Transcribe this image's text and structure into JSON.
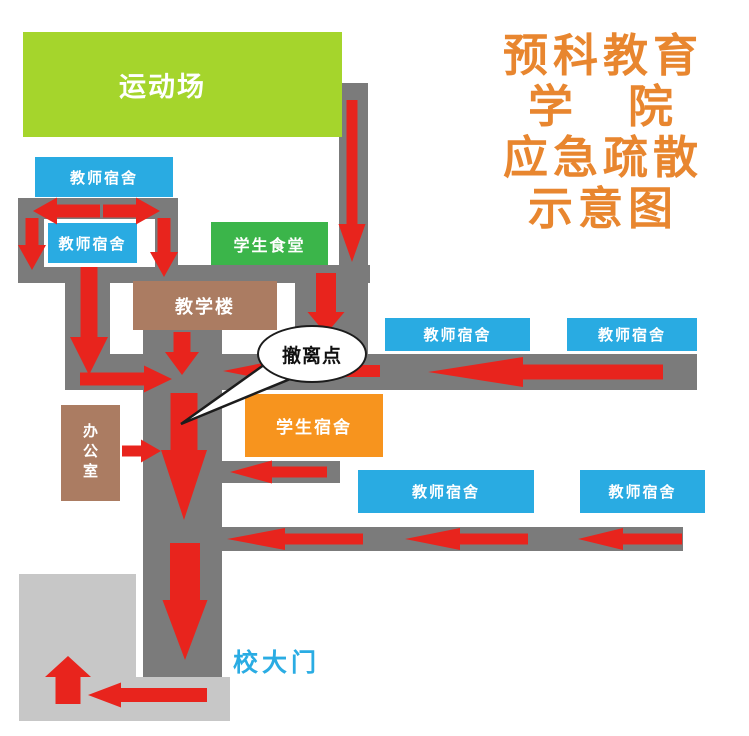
{
  "canvas": {
    "width": 749,
    "height": 736,
    "background": "#ffffff"
  },
  "colors": {
    "path_gray": "#7b7b7b",
    "open_area_gray": "#c7c7c7",
    "arrow_red": "#e8241d",
    "building_blue": "#29abe2",
    "canteen_green": "#3bb54a",
    "field_green": "#a5d52c",
    "dorm_orange": "#f7941e",
    "building_brown": "#ab7c62",
    "title_orange": "#e8862f",
    "gate_text_blue": "#2aace3",
    "bubble_outline": "#1c1c1c"
  },
  "title": {
    "lines": [
      "预科教育",
      "学　院",
      "应急疏散",
      "示意图"
    ],
    "x": 497,
    "y": 30,
    "w": 212
  },
  "gate": {
    "label": "校大门",
    "x": 233,
    "y": 643
  },
  "bubble": {
    "label": "撤离点",
    "cx": 310,
    "cy": 352,
    "rx": 53,
    "ry": 27,
    "tail_tip": [
      181,
      424
    ],
    "tail_base": [
      [
        268,
        362
      ],
      [
        295,
        377
      ]
    ]
  },
  "buildings": [
    {
      "name": "sports-field",
      "label": "运动场",
      "x": 23,
      "y": 32,
      "w": 319,
      "h": 105,
      "bg": "#a5d52c",
      "font": 27,
      "shift": -20
    },
    {
      "name": "teacher-dorm-1",
      "label": "教师宿舍",
      "x": 35,
      "y": 157,
      "w": 138,
      "h": 40,
      "bg": "#29abe2",
      "font": 15
    },
    {
      "name": "teacher-dorm-2",
      "label": "教师宿舍",
      "x": 44,
      "y": 219,
      "w": 111,
      "h": 48,
      "bg": "#29abe2",
      "font": 15,
      "border": {
        "color": "#ffffff",
        "t": 4,
        "r": 18,
        "b": 4,
        "l": 4
      }
    },
    {
      "name": "student-canteen",
      "label": "学生食堂",
      "x": 211,
      "y": 222,
      "w": 117,
      "h": 43,
      "bg": "#3bb54a",
      "font": 16
    },
    {
      "name": "teaching-building",
      "label": "教学楼",
      "x": 133,
      "y": 281,
      "w": 144,
      "h": 49,
      "bg": "#ab7c62",
      "font": 18
    },
    {
      "name": "office",
      "label": "办公室",
      "x": 61,
      "y": 405,
      "w": 59,
      "h": 96,
      "bg": "#ab7c62",
      "font": 15,
      "vertical": true
    },
    {
      "name": "student-dorm",
      "label": "学生宿舍",
      "x": 245,
      "y": 394,
      "w": 138,
      "h": 63,
      "bg": "#f7941e",
      "font": 17
    },
    {
      "name": "teacher-dorm-3",
      "label": "教师宿舍",
      "x": 385,
      "y": 318,
      "w": 145,
      "h": 33,
      "bg": "#29abe2",
      "font": 15
    },
    {
      "name": "teacher-dorm-4",
      "label": "教师宿舍",
      "x": 567,
      "y": 318,
      "w": 130,
      "h": 33,
      "bg": "#29abe2",
      "font": 15
    },
    {
      "name": "teacher-dorm-5",
      "label": "教师宿舍",
      "x": 358,
      "y": 470,
      "w": 176,
      "h": 43,
      "bg": "#29abe2",
      "font": 15
    },
    {
      "name": "teacher-dorm-6",
      "label": "教师宿舍",
      "x": 580,
      "y": 470,
      "w": 125,
      "h": 43,
      "bg": "#29abe2",
      "font": 15
    }
  ],
  "paths": [
    {
      "name": "path-top-left-block",
      "x": 18,
      "y": 198,
      "w": 160,
      "h": 85
    },
    {
      "name": "path-corridor-upper",
      "x": 18,
      "y": 265,
      "w": 352,
      "h": 18
    },
    {
      "name": "path-right-upper",
      "x": 339,
      "y": 83,
      "w": 29,
      "h": 182
    },
    {
      "name": "path-right-lower",
      "x": 295,
      "y": 265,
      "w": 73,
      "h": 92
    },
    {
      "name": "path-left-vertical",
      "x": 65,
      "y": 283,
      "w": 45,
      "h": 107
    },
    {
      "name": "path-main-corridor",
      "x": 65,
      "y": 354,
      "w": 632,
      "h": 36
    },
    {
      "name": "path-main-vertical",
      "x": 143,
      "y": 330,
      "w": 79,
      "h": 347
    },
    {
      "name": "path-stub-right",
      "x": 222,
      "y": 461,
      "w": 118,
      "h": 22
    },
    {
      "name": "path-corridor-lower",
      "x": 222,
      "y": 527,
      "w": 461,
      "h": 24
    }
  ],
  "open_areas": [
    {
      "name": "open-area-square",
      "x": 19,
      "y": 574,
      "w": 117,
      "h": 147
    },
    {
      "name": "open-area-corridor",
      "x": 136,
      "y": 677,
      "w": 94,
      "h": 44
    }
  ],
  "arrows": [
    {
      "name": "arrow-left-top",
      "dir": "left",
      "tip": [
        33,
        211
      ],
      "len": 67,
      "t": 13,
      "hl": 24,
      "hw": 27
    },
    {
      "name": "arrow-right-top",
      "dir": "right",
      "tip": [
        160,
        211
      ],
      "len": 57,
      "t": 13,
      "hl": 24,
      "hw": 27
    },
    {
      "name": "arrow-down-left-stub",
      "dir": "down",
      "tip": [
        32,
        270
      ],
      "len": 52,
      "t": 13,
      "hl": 25,
      "hw": 28
    },
    {
      "name": "arrow-down-mid-stub",
      "dir": "down",
      "tip": [
        164,
        277
      ],
      "len": 59,
      "t": 13,
      "hl": 25,
      "hw": 28
    },
    {
      "name": "arrow-down-right-path",
      "dir": "down",
      "tip": [
        352,
        262
      ],
      "len": 162,
      "t": 11,
      "hl": 38,
      "hw": 27
    },
    {
      "name": "arrow-down-right-lower",
      "dir": "down",
      "tip": [
        326,
        334
      ],
      "len": 61,
      "t": 20,
      "hl": 22,
      "hw": 37
    },
    {
      "name": "arrow-down-left-path",
      "dir": "down",
      "tip": [
        89,
        375
      ],
      "len": 108,
      "t": 17,
      "hl": 38,
      "hw": 38
    },
    {
      "name": "arrow-down-teaching",
      "dir": "down",
      "tip": [
        182,
        375
      ],
      "len": 43,
      "t": 17,
      "hl": 23,
      "hw": 34
    },
    {
      "name": "arrow-right-junction",
      "dir": "right",
      "tip": [
        172,
        379
      ],
      "len": 92,
      "t": 13,
      "hl": 28,
      "hw": 27
    },
    {
      "name": "arrow-left-junction",
      "dir": "left",
      "tip": [
        223,
        371
      ],
      "len": 157,
      "t": 12,
      "hl": 55,
      "hw": 22
    },
    {
      "name": "arrow-left-corridor-long",
      "dir": "left",
      "tip": [
        428,
        372
      ],
      "len": 235,
      "t": 15,
      "hl": 95,
      "hw": 30
    },
    {
      "name": "arrow-down-main-upper",
      "dir": "down",
      "tip": [
        184,
        520
      ],
      "len": 127,
      "t": 27,
      "hl": 70,
      "hw": 46
    },
    {
      "name": "arrow-down-main-lower",
      "dir": "down",
      "tip": [
        185,
        660
      ],
      "len": 117,
      "t": 30,
      "hl": 60,
      "hw": 45
    },
    {
      "name": "arrow-right-office",
      "dir": "right",
      "tip": [
        161,
        451
      ],
      "len": 39,
      "t": 11,
      "hl": 20,
      "hw": 23
    },
    {
      "name": "arrow-left-stub",
      "dir": "left",
      "tip": [
        230,
        472
      ],
      "len": 97,
      "t": 11,
      "hl": 42,
      "hw": 23
    },
    {
      "name": "arrow-left-lower-1",
      "dir": "left",
      "tip": [
        227,
        539
      ],
      "len": 136,
      "t": 11,
      "hl": 58,
      "hw": 22
    },
    {
      "name": "arrow-left-lower-2",
      "dir": "left",
      "tip": [
        405,
        539
      ],
      "len": 123,
      "t": 11,
      "hl": 55,
      "hw": 22
    },
    {
      "name": "arrow-left-lower-3",
      "dir": "left",
      "tip": [
        578,
        539
      ],
      "len": 104,
      "t": 11,
      "hl": 45,
      "hw": 22
    },
    {
      "name": "arrow-up-exit",
      "dir": "up",
      "tip": [
        68,
        656
      ],
      "len": 48,
      "t": 25,
      "hl": 21,
      "hw": 46
    },
    {
      "name": "arrow-left-exit",
      "dir": "left",
      "tip": [
        88,
        695
      ],
      "len": 119,
      "t": 14,
      "hl": 33,
      "hw": 25
    }
  ]
}
